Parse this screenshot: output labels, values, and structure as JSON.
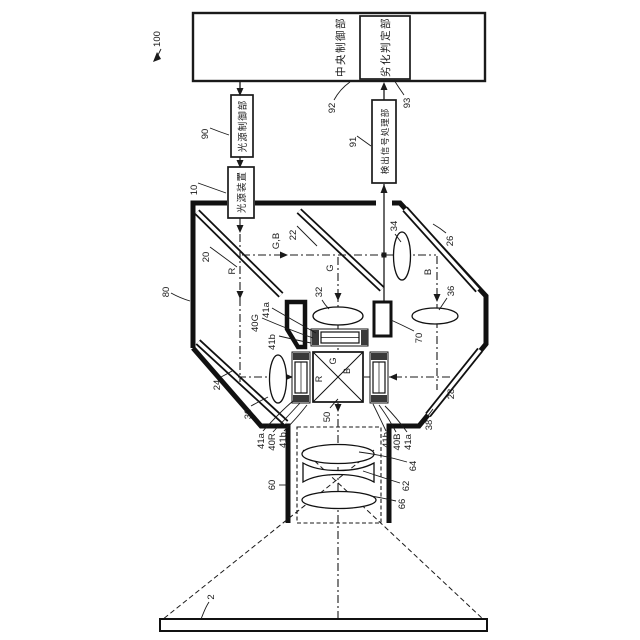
{
  "figure_title": "projector-optical-system-patent-figure",
  "boxes": {
    "central_control": "中央制御部",
    "deterioration_judging": "劣化判定部",
    "light_source_control": "光源制御部",
    "light_source_device": "光源装置",
    "detection_signal_processing": "検出信号処理部"
  },
  "refs": {
    "n100": "100",
    "n92": "92",
    "n93": "93",
    "n90": "90",
    "n91": "91",
    "n10": "10",
    "n80": "80",
    "n20": "20",
    "n22": "22",
    "n24": "24",
    "n26": "26",
    "n28": "28",
    "n30": "30",
    "n32": "32",
    "n34": "34",
    "n36": "36",
    "n38": "38",
    "n40G": "40G",
    "n40R": "40R",
    "n40B": "40B",
    "n41a": "41a",
    "n41b": "41b",
    "n50": "50",
    "n60": "60",
    "n62": "62",
    "n64": "64",
    "n66": "66",
    "n70": "70",
    "n2": "2"
  },
  "beam_labels": {
    "gb": "G,B",
    "r": "R",
    "g": "G",
    "b": "B"
  },
  "prism_faces": {
    "g": "G",
    "r": "R",
    "b": "B"
  },
  "colors": {
    "ink": "#1a1a1a",
    "paper": "#ffffff",
    "cap_fill": "#3a3a3a"
  }
}
